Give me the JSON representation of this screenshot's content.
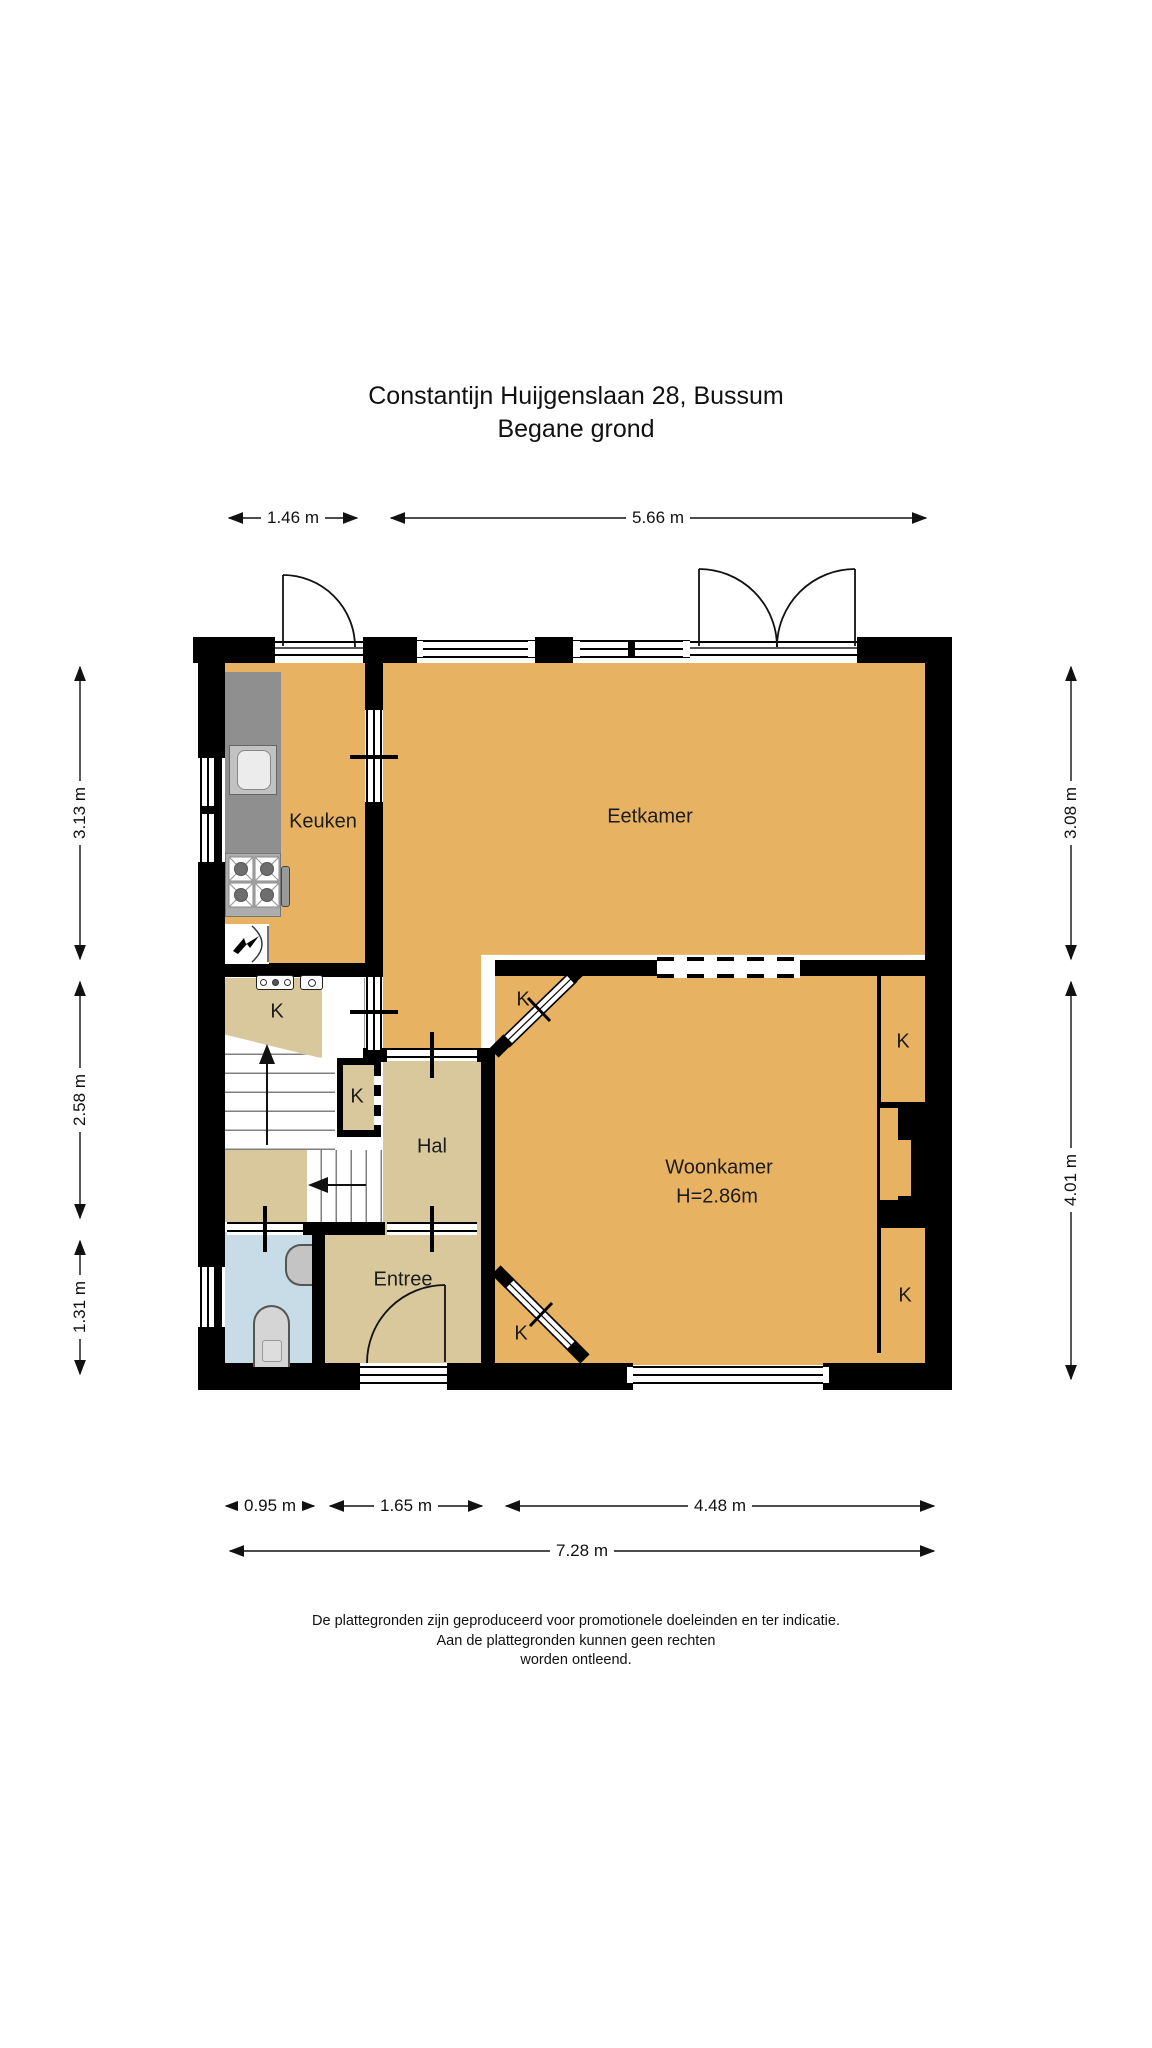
{
  "title": {
    "line1": "Constantijn Huijgenslaan 28, Bussum",
    "line2": "Begane grond"
  },
  "rooms": {
    "keuken": "Keuken",
    "eetkamer": "Eetkamer",
    "woonkamer": "Woonkamer",
    "woonkamer_height": "H=2.86m",
    "hal": "Hal",
    "entree": "Entree"
  },
  "k_labels": [
    "K",
    "K",
    "K",
    "K",
    "K",
    "K"
  ],
  "dimensions": {
    "top": [
      "1.46 m",
      "5.66 m"
    ],
    "left": [
      "3.13 m",
      "2.58 m",
      "1.31 m"
    ],
    "right": [
      "3.08 m",
      "4.01 m"
    ],
    "bottom": [
      "0.95 m",
      "1.65 m",
      "4.48 m"
    ],
    "total": "7.28 m"
  },
  "footer": {
    "line1": "De plattegronden zijn geproduceerd voor promotionele doeleinden en ter indicatie.",
    "line2": "Aan de plattegronden kunnen geen rechten",
    "line3": "worden ontleend."
  },
  "colors": {
    "room_orange": "#E8B263",
    "room_tan": "#D8C89C",
    "bathroom_blue": "#C8DCE8",
    "wall_black": "#000000",
    "counter_gray": "#8F8F8F"
  }
}
